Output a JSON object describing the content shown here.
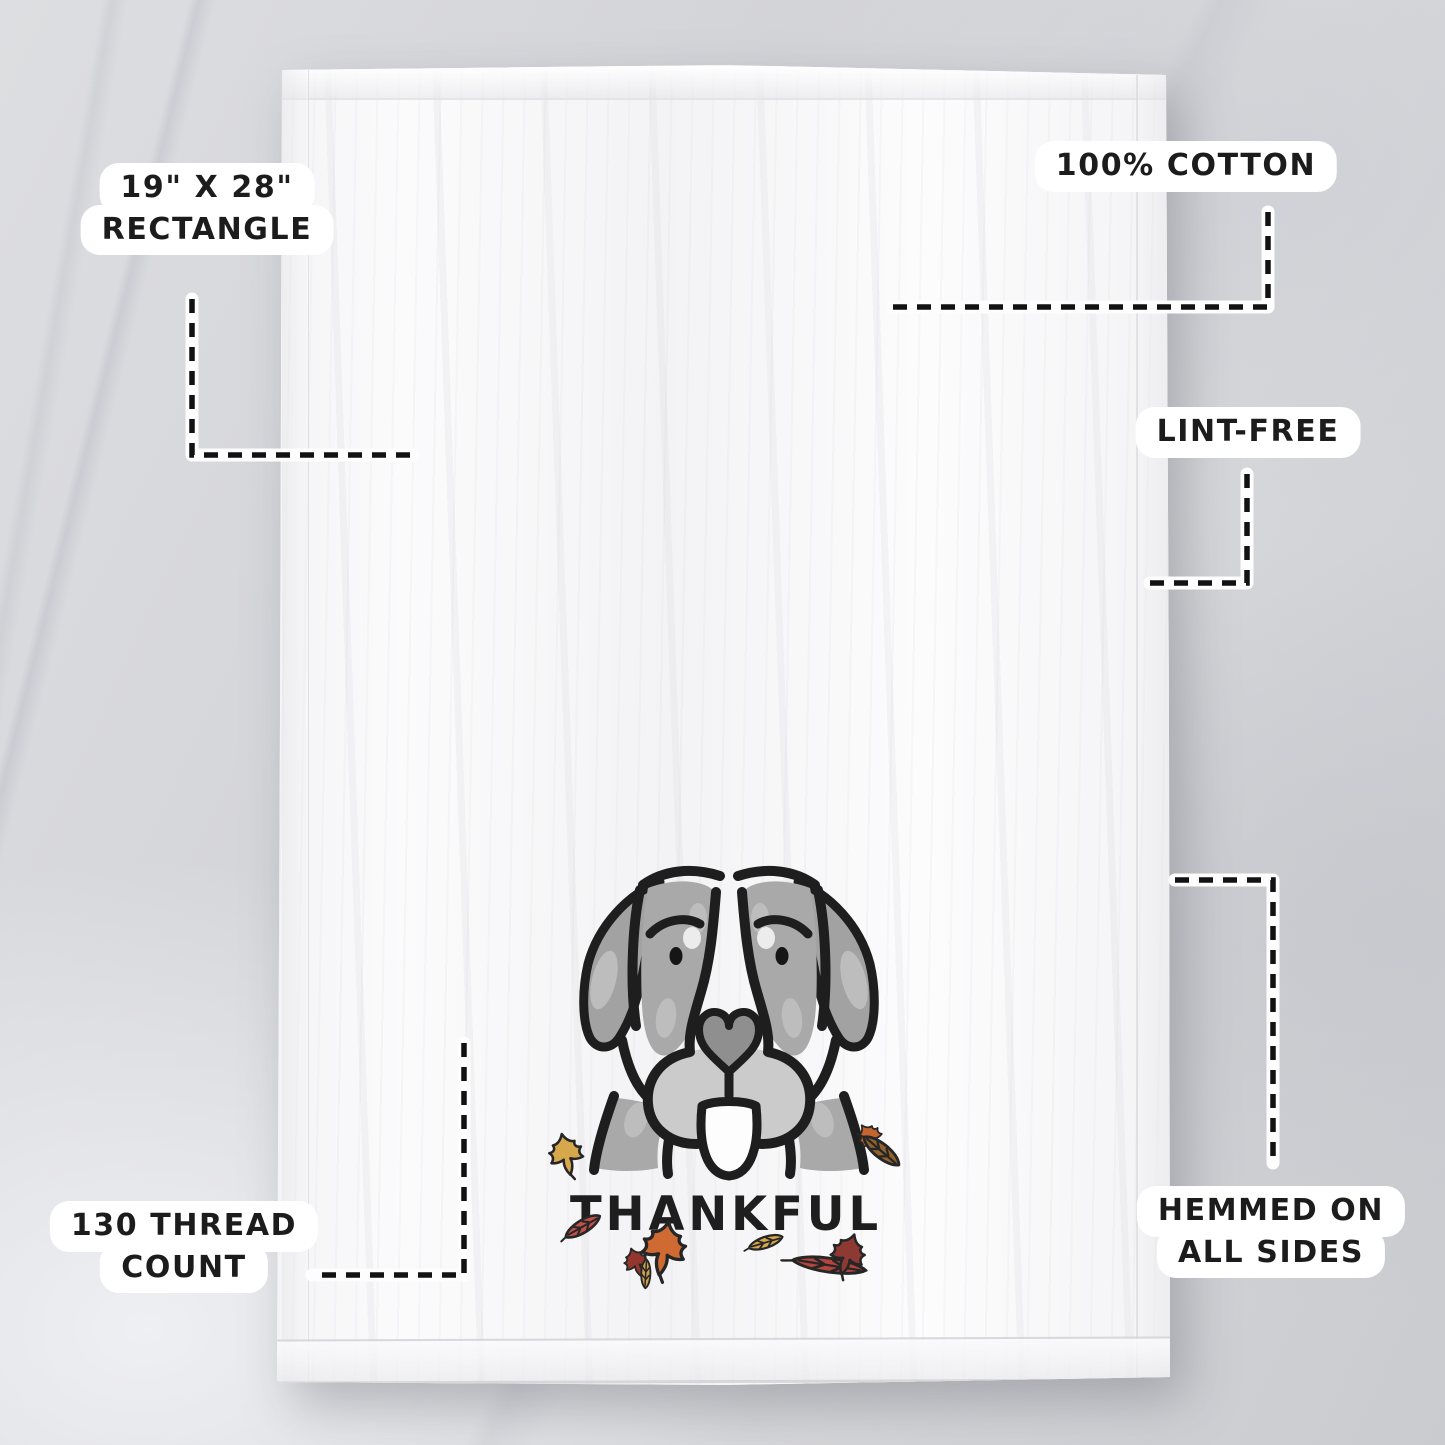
{
  "design": {
    "text": "THANKFUL"
  },
  "callouts": {
    "size": {
      "line1": "19\" X 28\"",
      "line2": "RECTANGLE"
    },
    "material": {
      "line1": "100% COTTON"
    },
    "lint": {
      "line1": "LINT-FREE"
    },
    "thread": {
      "line1": "130 THREAD",
      "line2": "COUNT"
    },
    "hem": {
      "line1": "HEMMED ON",
      "line2": "ALL SIDES"
    }
  },
  "colors": {
    "label_bg": "#ffffff",
    "label_text": "#1c1c1c",
    "leader_dash": "#121212",
    "leader_casing": "#fdfdfd",
    "towel_white": "#f7f7f8",
    "marble_gray": "#d4d5d8",
    "outline_black": "#1e1e1e",
    "dog_gray": "#a2a2a2",
    "dog_gray_mid": "#a9a9a9",
    "dog_gray_light": "#bdbdbd",
    "nose_gray": "#8f8f8f",
    "muzzle_gray": "#cbcbcb",
    "tongue_white": "#fdfdfd",
    "leaf_yellow": "#d7a74b",
    "leaf_red": "#c0504a",
    "leaf_orange": "#cf6a33",
    "leaf_dark_red": "#93372e",
    "leaf_tan": "#cfa14e",
    "leaf_red_right": "#b5443e",
    "leaf_maroon": "#8e3a33",
    "leaf_brown": "#93622d",
    "leaf_orange_small": "#c4652f"
  }
}
